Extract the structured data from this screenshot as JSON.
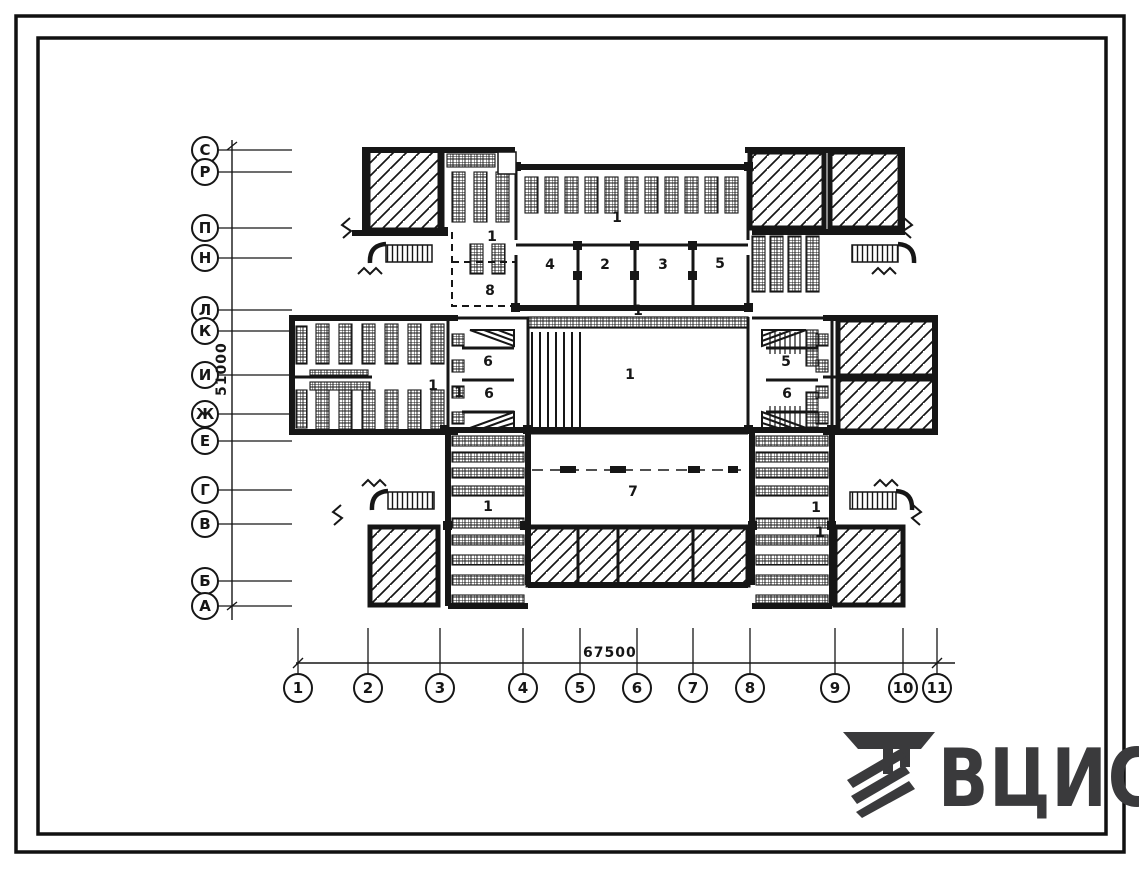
{
  "sheet": {
    "type_label": "floor-plan-drawing"
  },
  "axes": {
    "left": {
      "dimension": "51000",
      "labels": [
        {
          "label": "С",
          "y": 150
        },
        {
          "label": "Р",
          "y": 172
        },
        {
          "label": "П",
          "y": 228
        },
        {
          "label": "Н",
          "y": 258
        },
        {
          "label": "Л",
          "y": 310
        },
        {
          "label": "К",
          "y": 331
        },
        {
          "label": "И",
          "y": 375
        },
        {
          "label": "Ж",
          "y": 414
        },
        {
          "label": "Е",
          "y": 441
        },
        {
          "label": "Г",
          "y": 490
        },
        {
          "label": "В",
          "y": 524
        },
        {
          "label": "Б",
          "y": 581
        },
        {
          "label": "А",
          "y": 606
        }
      ]
    },
    "bottom": {
      "dimension": "67500",
      "labels": [
        {
          "label": "1",
          "x": 298
        },
        {
          "label": "2",
          "x": 368
        },
        {
          "label": "3",
          "x": 440
        },
        {
          "label": "4",
          "x": 523
        },
        {
          "label": "5",
          "x": 580
        },
        {
          "label": "6",
          "x": 637
        },
        {
          "label": "7",
          "x": 693
        },
        {
          "label": "8",
          "x": 750
        },
        {
          "label": "9",
          "x": 835
        },
        {
          "label": "10",
          "x": 903
        },
        {
          "label": "11",
          "x": 937
        }
      ]
    }
  },
  "rooms": [
    {
      "label": "1",
      "x": 617,
      "y": 222
    },
    {
      "label": "1",
      "x": 492,
      "y": 241
    },
    {
      "label": "8",
      "x": 490,
      "y": 295
    },
    {
      "label": "4",
      "x": 550,
      "y": 269
    },
    {
      "label": "2",
      "x": 605,
      "y": 269
    },
    {
      "label": "3",
      "x": 663,
      "y": 269
    },
    {
      "label": "5",
      "x": 720,
      "y": 268
    },
    {
      "label": "1",
      "x": 638,
      "y": 315
    },
    {
      "label": "1",
      "x": 630,
      "y": 379
    },
    {
      "label": "1",
      "x": 433,
      "y": 390
    },
    {
      "label": "1",
      "x": 459,
      "y": 397
    },
    {
      "label": "6",
      "x": 488,
      "y": 366
    },
    {
      "label": "6",
      "x": 489,
      "y": 398
    },
    {
      "label": "5",
      "x": 786,
      "y": 366
    },
    {
      "label": "6",
      "x": 787,
      "y": 398
    },
    {
      "label": "7",
      "x": 633,
      "y": 496
    },
    {
      "label": "1",
      "x": 488,
      "y": 511
    },
    {
      "label": "1",
      "x": 816,
      "y": 512
    },
    {
      "label": "1",
      "x": 820,
      "y": 537
    }
  ],
  "logo": {
    "text": "ВЦИС"
  },
  "colors": {
    "ink": "#161616",
    "logo": "#3a3a3c",
    "paper": "#ffffff"
  }
}
